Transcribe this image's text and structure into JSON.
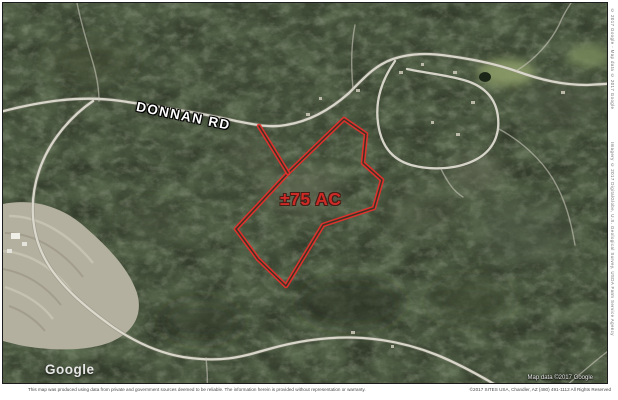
{
  "map": {
    "labels": {
      "road": "DONNAN RD",
      "acreage": "±75 AC"
    },
    "credits": {
      "watermark": "Google",
      "map_data": "Map data ©2017 Google"
    },
    "colors": {
      "parcel_outline": "#e5302c",
      "acreage_text": "#ce2a26",
      "road_label_text": "#ffffff",
      "forest_base": "#343d2c",
      "cleared_field": "#b4b0a0"
    }
  },
  "margins": {
    "bottom": {
      "disclaimer": "This map was produced using data from private and government sources deemed to be reliable. The information herein is provided without representation or warranty.",
      "attribution": "©2017 SITES USA, Chandler, AZ (480) 491-1112 All Rights Reserved"
    },
    "right": {
      "credit_top": "© 2017 Google - Map data © 2017 Google",
      "credit_middle": "Imagery © 2017 DigitalGlobe, U.S. Geological Survey, USDA Farm Service Agency"
    }
  }
}
